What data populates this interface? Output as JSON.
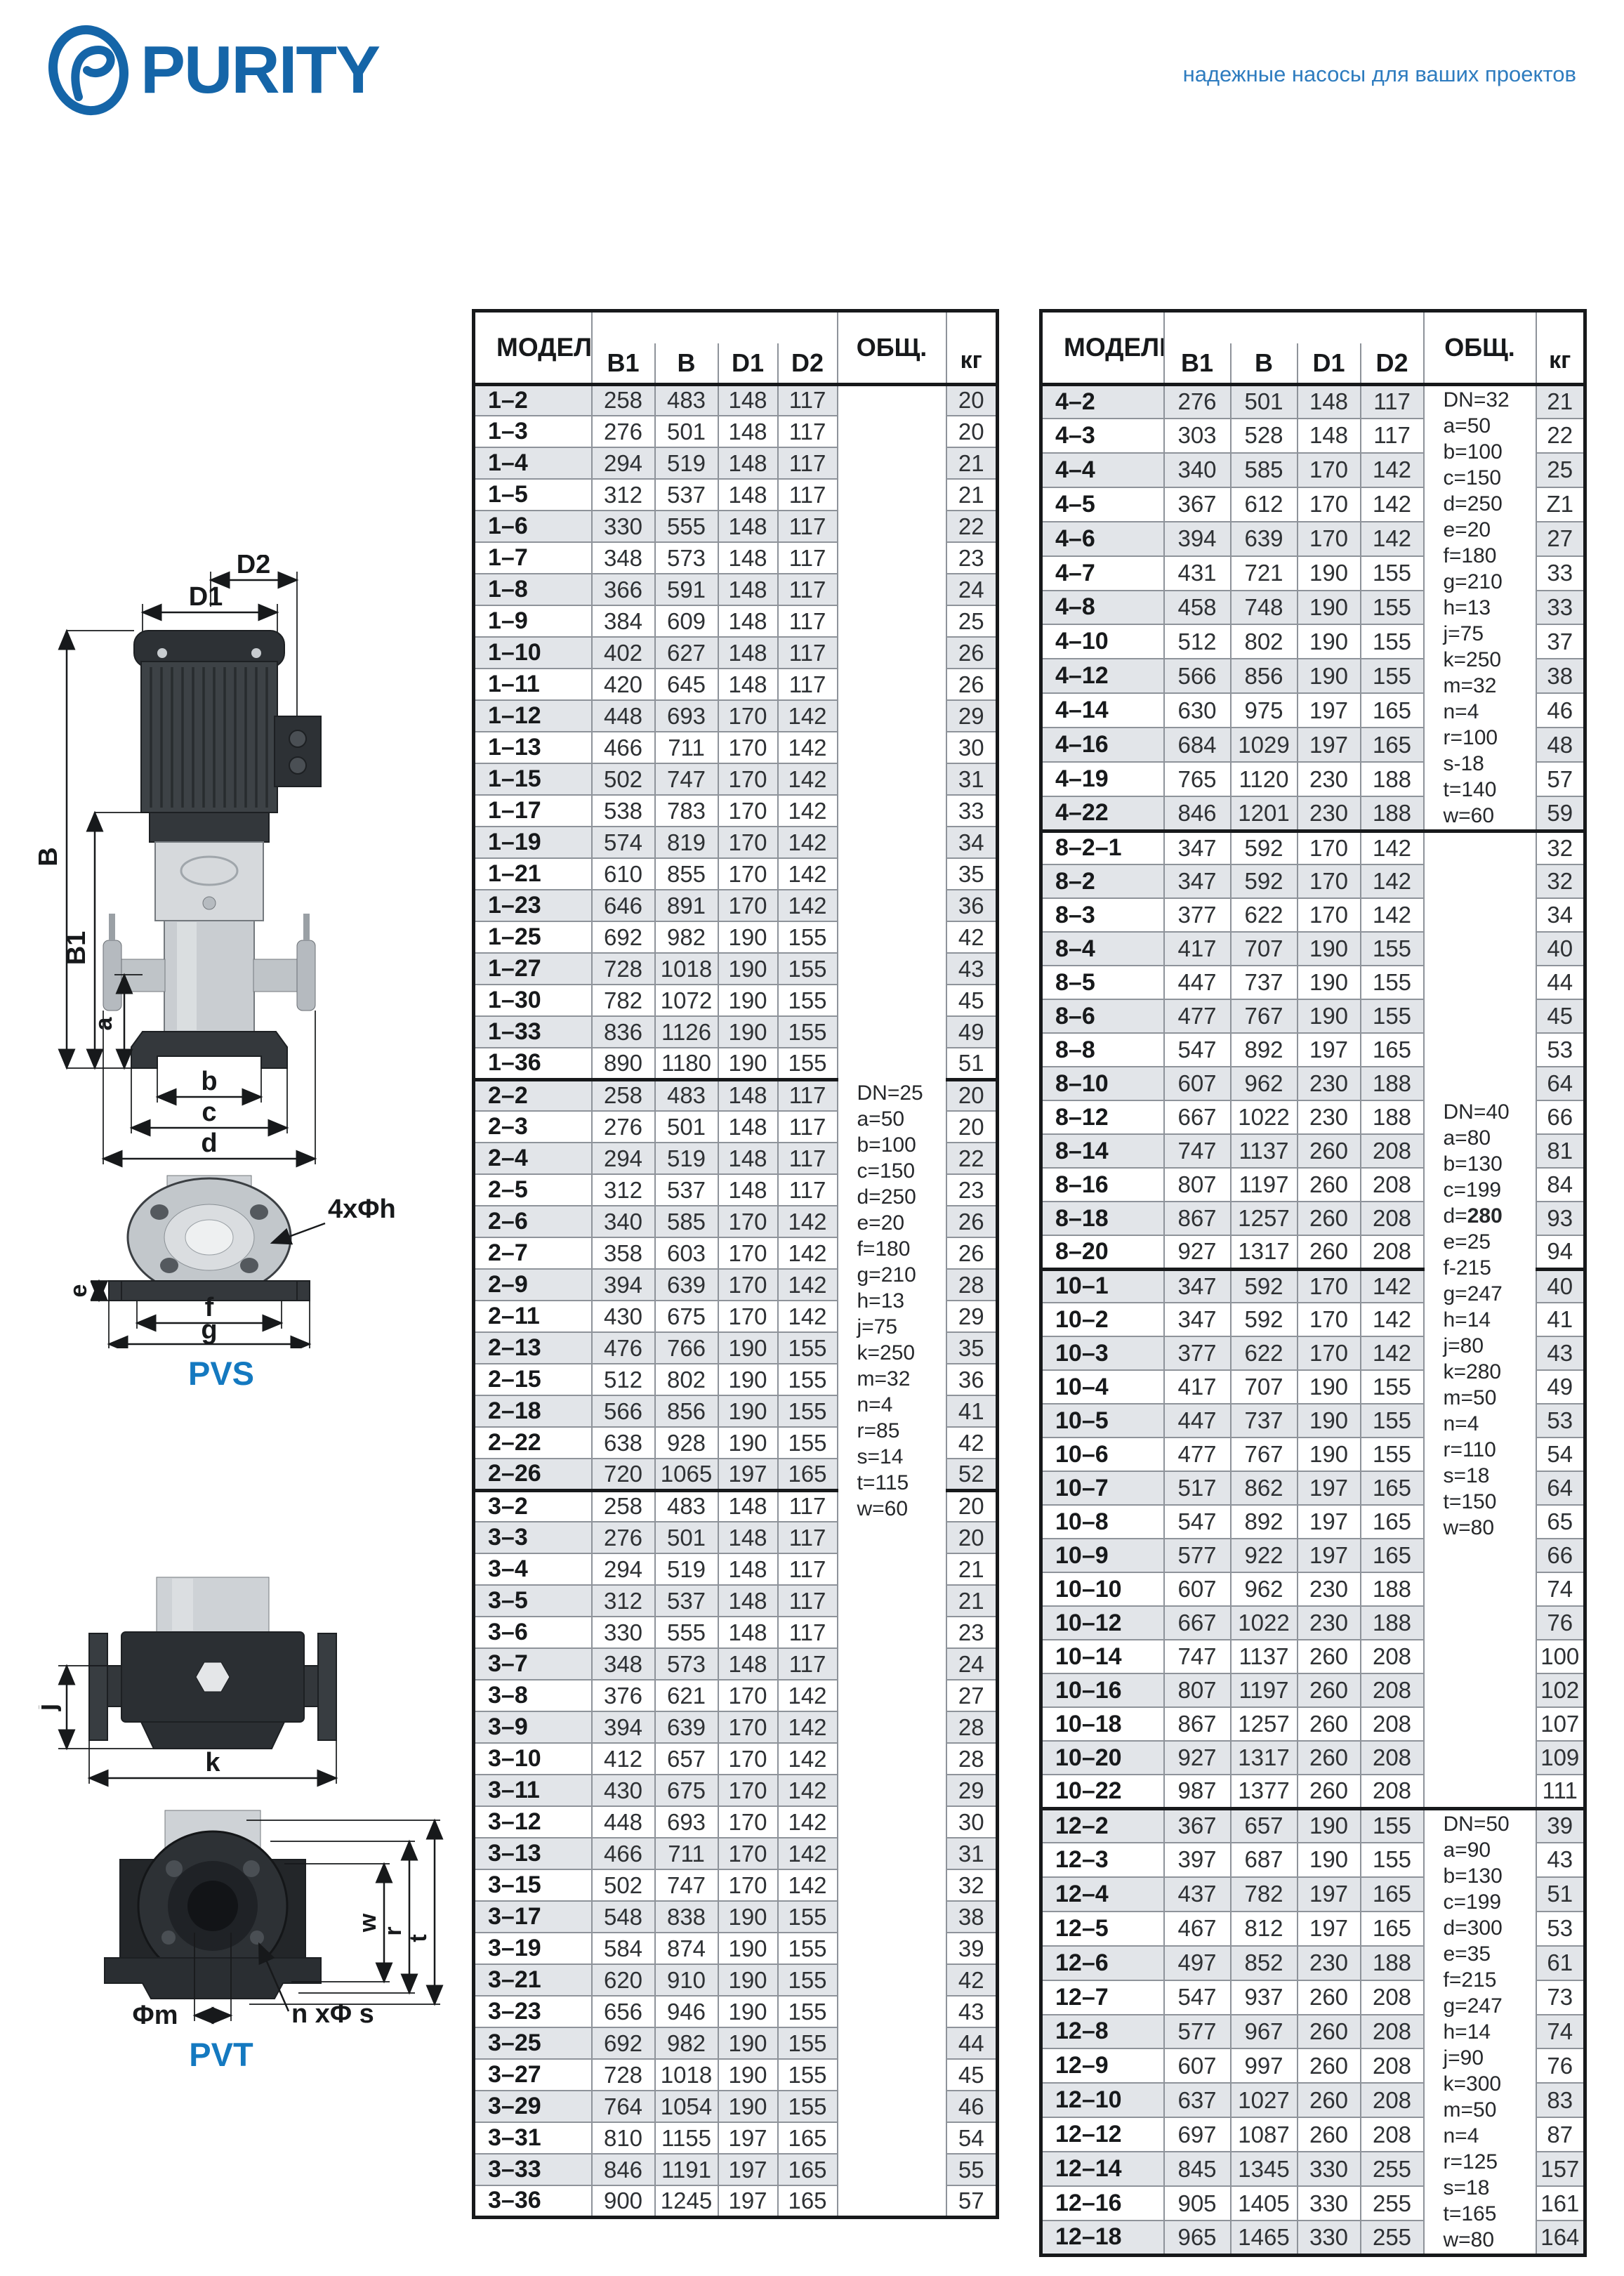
{
  "brand": {
    "name": "PURITY",
    "tagline": "надежные насосы для ваших проектов"
  },
  "colors": {
    "brand_blue": "#1565a8",
    "tagline_blue": "#2e7cbf",
    "diagram_label_blue": "#1479c0",
    "row_shade": "#e2e5e9",
    "grid_gray": "#8e939a",
    "frame_black": "#17191b"
  },
  "diagrams": {
    "pvs": {
      "label": "PVS",
      "dims": {
        "d1": "D1",
        "d2": "D2",
        "b": "B",
        "b1": "B1",
        "a": "a",
        "bb": "b",
        "c": "c",
        "d": "d",
        "e": "e",
        "f": "f",
        "g": "g",
        "holes": "4xΦh"
      }
    },
    "pvt": {
      "label": "PVT",
      "dims": {
        "j": "j",
        "k": "k",
        "w": "w",
        "r": "r",
        "t": "t",
        "m": "Φm",
        "holes": "n xΦ s"
      }
    }
  },
  "tables": [
    {
      "header": {
        "model": "МОДЕЛЬ",
        "b1": "B1",
        "b": "B",
        "d1": "D1",
        "d2": "D2",
        "obsh": "ОБЩ.",
        "kg": "кг"
      },
      "section_breaks": [
        22,
        35
      ],
      "note_groups": [
        {
          "rows": 58,
          "lines": [
            "DN=25",
            "a=50",
            "b=100",
            "c=150",
            "d=250",
            "e=20",
            "f=180",
            "g=210",
            "h=13",
            "j=75",
            "k=250",
            "m=32",
            "n=4",
            "r=85",
            "s=14",
            "t=115",
            "w=60"
          ]
        }
      ],
      "rows": [
        [
          "1–2",
          258,
          483,
          148,
          117,
          "20"
        ],
        [
          "1–3",
          276,
          501,
          148,
          117,
          "20"
        ],
        [
          "1–4",
          294,
          519,
          148,
          117,
          "21"
        ],
        [
          "1–5",
          312,
          537,
          148,
          117,
          "21"
        ],
        [
          "1–6",
          330,
          555,
          148,
          117,
          "22"
        ],
        [
          "1–7",
          348,
          573,
          148,
          117,
          "23"
        ],
        [
          "1–8",
          366,
          591,
          148,
          117,
          "24"
        ],
        [
          "1–9",
          384,
          609,
          148,
          117,
          "25"
        ],
        [
          "1–10",
          402,
          627,
          148,
          117,
          "26"
        ],
        [
          "1–11",
          420,
          645,
          148,
          117,
          "26"
        ],
        [
          "1–12",
          448,
          693,
          170,
          142,
          "29"
        ],
        [
          "1–13",
          466,
          711,
          170,
          142,
          "30"
        ],
        [
          "1–15",
          502,
          747,
          170,
          142,
          "31"
        ],
        [
          "1–17",
          538,
          783,
          170,
          142,
          "33"
        ],
        [
          "1–19",
          574,
          819,
          170,
          142,
          "34"
        ],
        [
          "1–21",
          610,
          855,
          170,
          142,
          "35"
        ],
        [
          "1–23",
          646,
          891,
          170,
          142,
          "36"
        ],
        [
          "1–25",
          692,
          982,
          190,
          155,
          "42"
        ],
        [
          "1–27",
          728,
          1018,
          190,
          155,
          "43"
        ],
        [
          "1–30",
          782,
          1072,
          190,
          155,
          "45"
        ],
        [
          "1–33",
          836,
          1126,
          190,
          155,
          "49"
        ],
        [
          "1–36",
          890,
          1180,
          190,
          155,
          "51"
        ],
        [
          "2–2",
          258,
          483,
          148,
          117,
          "20"
        ],
        [
          "2–3",
          276,
          501,
          148,
          117,
          "20"
        ],
        [
          "2–4",
          294,
          519,
          148,
          117,
          "22"
        ],
        [
          "2–5",
          312,
          537,
          148,
          117,
          "23"
        ],
        [
          "2–6",
          340,
          585,
          170,
          142,
          "26"
        ],
        [
          "2–7",
          358,
          603,
          170,
          142,
          "26"
        ],
        [
          "2–9",
          394,
          639,
          170,
          142,
          "28"
        ],
        [
          "2–11",
          430,
          675,
          170,
          142,
          "29"
        ],
        [
          "2–13",
          476,
          766,
          190,
          155,
          "35"
        ],
        [
          "2–15",
          512,
          802,
          190,
          155,
          "36"
        ],
        [
          "2–18",
          566,
          856,
          190,
          155,
          "41"
        ],
        [
          "2–22",
          638,
          928,
          190,
          155,
          "42"
        ],
        [
          "2–26",
          720,
          1065,
          197,
          165,
          "52"
        ],
        [
          "3–2",
          258,
          483,
          148,
          117,
          "20"
        ],
        [
          "3–3",
          276,
          501,
          148,
          117,
          "20"
        ],
        [
          "3–4",
          294,
          519,
          148,
          117,
          "21"
        ],
        [
          "3–5",
          312,
          537,
          148,
          117,
          "21"
        ],
        [
          "3–6",
          330,
          555,
          148,
          117,
          "23"
        ],
        [
          "3–7",
          348,
          573,
          148,
          117,
          "24"
        ],
        [
          "3–8",
          376,
          621,
          170,
          142,
          "27"
        ],
        [
          "3–9",
          394,
          639,
          170,
          142,
          "28"
        ],
        [
          "3–10",
          412,
          657,
          170,
          142,
          "28"
        ],
        [
          "3–11",
          430,
          675,
          170,
          142,
          "29"
        ],
        [
          "3–12",
          448,
          693,
          170,
          142,
          "30"
        ],
        [
          "3–13",
          466,
          711,
          170,
          142,
          "31"
        ],
        [
          "3–15",
          502,
          747,
          170,
          142,
          "32"
        ],
        [
          "3–17",
          548,
          838,
          190,
          155,
          "38"
        ],
        [
          "3–19",
          584,
          874,
          190,
          155,
          "39"
        ],
        [
          "3–21",
          620,
          910,
          190,
          155,
          "42"
        ],
        [
          "3–23",
          656,
          946,
          190,
          155,
          "43"
        ],
        [
          "3–25",
          692,
          982,
          190,
          155,
          "44"
        ],
        [
          "3–27",
          728,
          1018,
          190,
          155,
          "45"
        ],
        [
          "3–29",
          764,
          1054,
          190,
          155,
          "46"
        ],
        [
          "3–31",
          810,
          1155,
          197,
          165,
          "54"
        ],
        [
          "3–33",
          846,
          1191,
          197,
          165,
          "55"
        ],
        [
          "3–36",
          900,
          1245,
          197,
          165,
          "57"
        ]
      ]
    },
    {
      "header": {
        "model": "МОДЕЛЬ",
        "b1": "B1",
        "b": "B",
        "d1": "D1",
        "d2": "D2",
        "obsh": "ОБЩ.",
        "kg": "кг"
      },
      "section_breaks": [
        13,
        26,
        42
      ],
      "note_groups": [
        {
          "rows": 13,
          "lines": [
            "DN=32",
            "a=50",
            "b=100",
            "c=150",
            "d=250",
            "e=20",
            "f=180",
            "g=210",
            "h=13",
            "j=75",
            "k=250",
            "m=32",
            "n=4",
            "r=100",
            "s-18",
            "t=140",
            "w=60"
          ]
        },
        {
          "rows": 29,
          "bold_line": 4,
          "lines": [
            "DN=40",
            "a=80",
            "b=130",
            "c=199",
            "d=280",
            "e=25",
            "f-215",
            "g=247",
            "h=14",
            "j=80",
            "k=280",
            "m=50",
            "n=4",
            "r=110",
            "s=18",
            "t=150",
            "w=80"
          ]
        },
        {
          "rows": 13,
          "lines": [
            "DN=50",
            "a=90",
            "b=130",
            "c=199",
            "d=300",
            "e=35",
            "f=215",
            "g=247",
            "h=14",
            "j=90",
            "k=300",
            "m=50",
            "n=4",
            "r=125",
            "s=18",
            "t=165",
            "w=80"
          ]
        }
      ],
      "rows": [
        [
          "4–2",
          276,
          501,
          148,
          117,
          "21"
        ],
        [
          "4–3",
          303,
          528,
          148,
          117,
          "22"
        ],
        [
          "4–4",
          340,
          585,
          170,
          142,
          "25"
        ],
        [
          "4–5",
          367,
          612,
          170,
          142,
          "Z1"
        ],
        [
          "4–6",
          394,
          639,
          170,
          142,
          "27"
        ],
        [
          "4–7",
          431,
          721,
          190,
          155,
          "33"
        ],
        [
          "4–8",
          458,
          748,
          190,
          155,
          "33"
        ],
        [
          "4–10",
          512,
          802,
          190,
          155,
          "37"
        ],
        [
          "4–12",
          566,
          856,
          190,
          155,
          "38"
        ],
        [
          "4–14",
          630,
          975,
          197,
          165,
          "46"
        ],
        [
          "4–16",
          684,
          1029,
          197,
          165,
          "48"
        ],
        [
          "4–19",
          765,
          1120,
          230,
          188,
          "57"
        ],
        [
          "4–22",
          846,
          1201,
          230,
          188,
          "59"
        ],
        [
          "8–2–1",
          347,
          592,
          170,
          142,
          "32"
        ],
        [
          "8–2",
          347,
          592,
          170,
          142,
          "32"
        ],
        [
          "8–3",
          377,
          622,
          170,
          142,
          "34"
        ],
        [
          "8–4",
          417,
          707,
          190,
          155,
          "40"
        ],
        [
          "8–5",
          447,
          737,
          190,
          155,
          "44"
        ],
        [
          "8–6",
          477,
          767,
          190,
          155,
          "45"
        ],
        [
          "8–8",
          547,
          892,
          197,
          165,
          "53"
        ],
        [
          "8–10",
          607,
          962,
          230,
          188,
          "64"
        ],
        [
          "8–12",
          667,
          1022,
          230,
          188,
          "66"
        ],
        [
          "8–14",
          747,
          1137,
          260,
          208,
          "81"
        ],
        [
          "8–16",
          807,
          1197,
          260,
          208,
          "84"
        ],
        [
          "8–18",
          867,
          1257,
          260,
          208,
          "93"
        ],
        [
          "8–20",
          927,
          1317,
          260,
          208,
          "94"
        ],
        [
          "10–1",
          347,
          592,
          170,
          142,
          "40"
        ],
        [
          "10–2",
          347,
          592,
          170,
          142,
          "41"
        ],
        [
          "10–3",
          377,
          622,
          170,
          142,
          "43"
        ],
        [
          "10–4",
          417,
          707,
          190,
          155,
          "49"
        ],
        [
          "10–5",
          447,
          737,
          190,
          155,
          "53"
        ],
        [
          "10–6",
          477,
          767,
          190,
          155,
          "54"
        ],
        [
          "10–7",
          517,
          862,
          197,
          165,
          "64"
        ],
        [
          "10–8",
          547,
          892,
          197,
          165,
          "65"
        ],
        [
          "10–9",
          577,
          922,
          197,
          165,
          "66"
        ],
        [
          "10–10",
          607,
          962,
          230,
          188,
          "74"
        ],
        [
          "10–12",
          667,
          1022,
          230,
          188,
          "76"
        ],
        [
          "10–14",
          747,
          1137,
          260,
          208,
          "100"
        ],
        [
          "10–16",
          807,
          1197,
          260,
          208,
          "102"
        ],
        [
          "10–18",
          867,
          1257,
          260,
          208,
          "107"
        ],
        [
          "10–20",
          927,
          1317,
          260,
          208,
          "109"
        ],
        [
          "10–22",
          987,
          1377,
          260,
          208,
          "111"
        ],
        [
          "12–2",
          367,
          657,
          190,
          155,
          "39"
        ],
        [
          "12–3",
          397,
          687,
          190,
          155,
          "43"
        ],
        [
          "12–4",
          437,
          782,
          197,
          165,
          "51"
        ],
        [
          "12–5",
          467,
          812,
          197,
          165,
          "53"
        ],
        [
          "12–6",
          497,
          852,
          230,
          188,
          "61"
        ],
        [
          "12–7",
          547,
          937,
          260,
          208,
          "73"
        ],
        [
          "12–8",
          577,
          967,
          260,
          208,
          "74"
        ],
        [
          "12–9",
          607,
          997,
          260,
          208,
          "76"
        ],
        [
          "12–10",
          637,
          1027,
          260,
          208,
          "83"
        ],
        [
          "12–12",
          697,
          1087,
          260,
          208,
          "87"
        ],
        [
          "12–14",
          845,
          1345,
          330,
          255,
          "157"
        ],
        [
          "12–16",
          905,
          1405,
          330,
          255,
          "161"
        ],
        [
          "12–18",
          965,
          1465,
          330,
          255,
          "164"
        ]
      ]
    }
  ]
}
